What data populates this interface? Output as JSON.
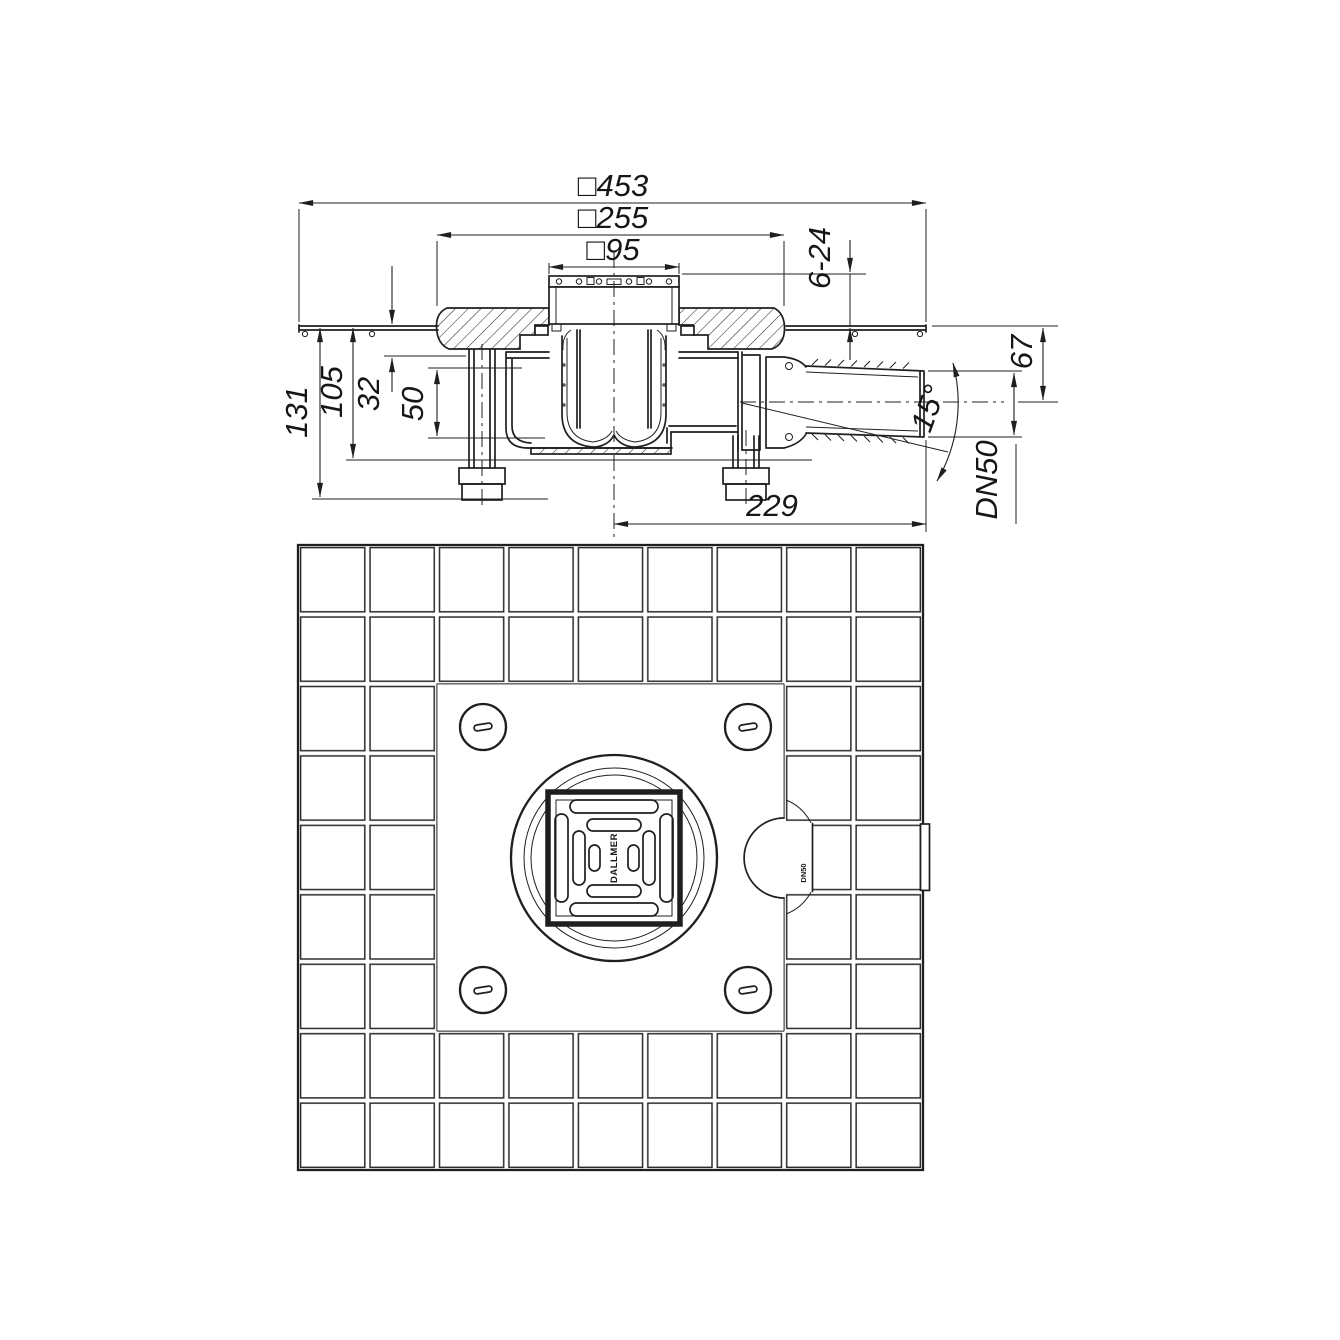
{
  "title": "Floor drain technical drawing",
  "dims": {
    "overall": "□453",
    "flange": "□255",
    "frame": "□95",
    "tile_range": "6-24",
    "height_total": "131",
    "height_body": "105",
    "flange_depth": "32",
    "water_seal": "50",
    "outlet_height": "67",
    "outlet_offset": "229",
    "outlet_angle": "15°",
    "outlet_dn": "DN50"
  },
  "plan": {
    "grate_brand": "DALLMER",
    "pipe_marking": "DN50"
  },
  "colors": {
    "line": "#1f1f1f",
    "background": "#ffffff"
  }
}
